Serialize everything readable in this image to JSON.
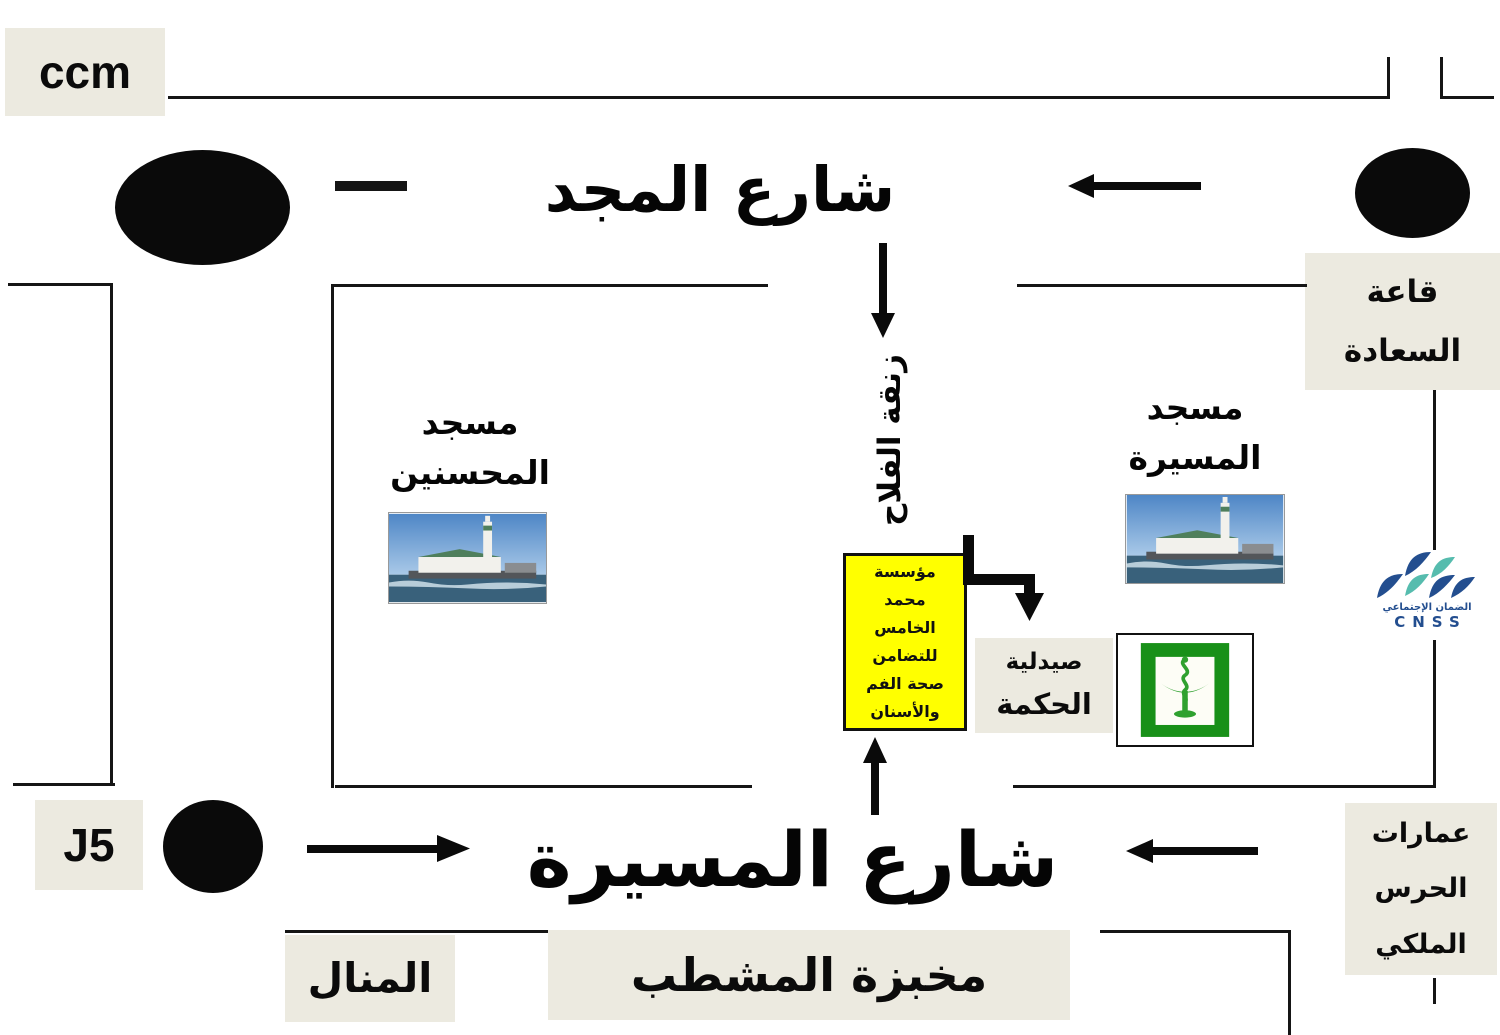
{
  "colors": {
    "label_bg": "#ECEAE0",
    "foundation_bg": "#FFFF00",
    "line": "#151515",
    "cnss_navy": "#234E8F",
    "cnss_teal": "#56BCAE",
    "pharmacy_green": "#189018"
  },
  "labels": {
    "ccm": "ccm",
    "majd_street": "شارع المجد",
    "saada_hall": [
      "قاعة",
      "السعادة"
    ],
    "mohsinin_mosque": [
      "مسجد",
      "المحسنين"
    ],
    "massira_mosque": [
      "مسجد",
      "المسيرة"
    ],
    "falah_alley": "زنقة الفلاح",
    "foundation": [
      "مؤسسة",
      "محمد",
      "الخامس",
      "للتضامن",
      "صحة الفم",
      "والأسنان"
    ],
    "pharmacy": [
      "صيدلية",
      "الحكمة"
    ],
    "cnss_arabic": "الضمان الإجتماعي",
    "cnss_latin": "CNSS",
    "j5": "J5",
    "massira_street": "شارع المسيرة",
    "guard_buildings": [
      "عمارات",
      "الحرس",
      "الملكي"
    ],
    "manal": "المنال",
    "bakery": "مخبزة المشطب"
  }
}
